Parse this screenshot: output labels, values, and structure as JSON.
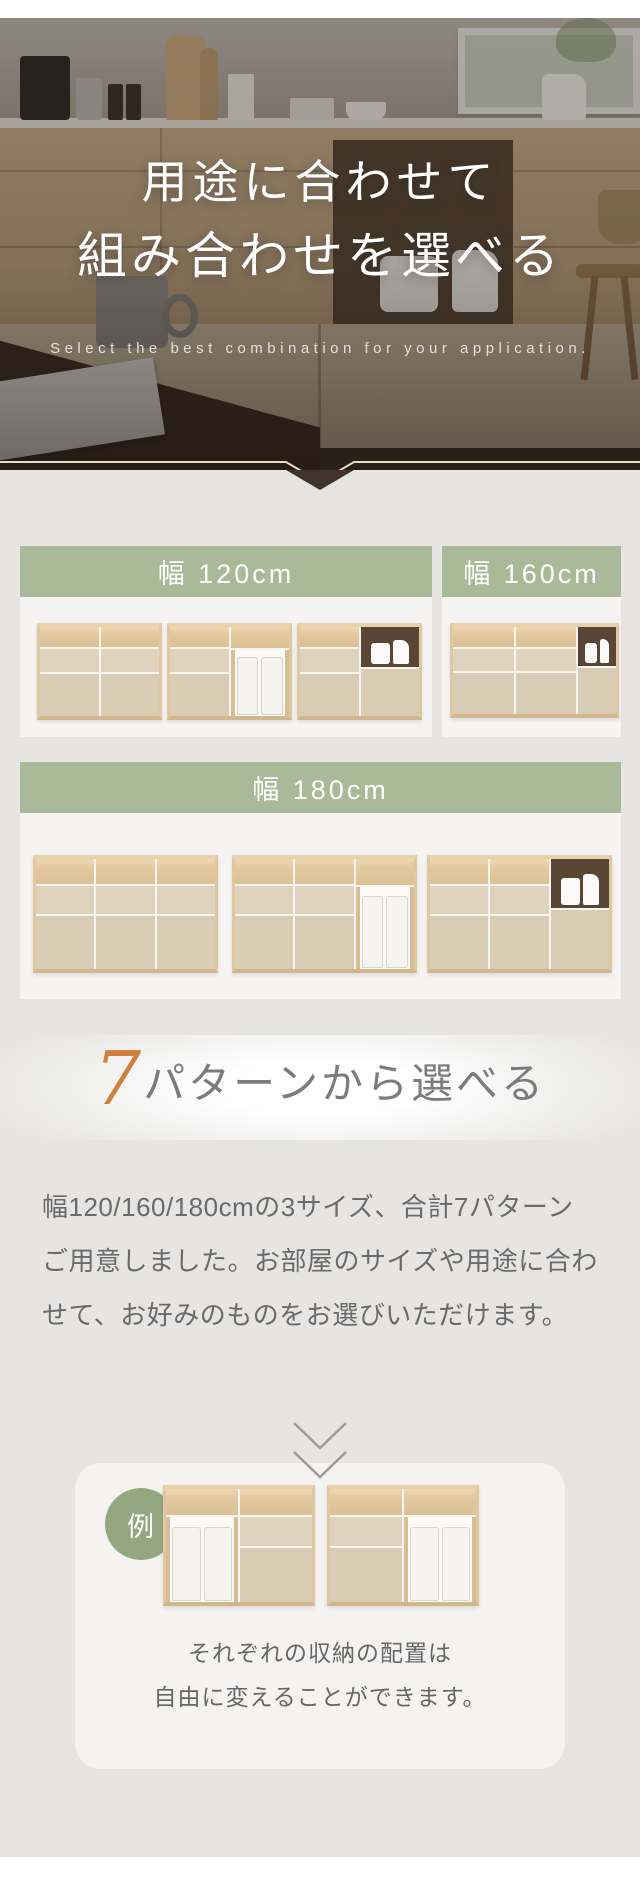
{
  "hero": {
    "title_line1": "用途に合わせて",
    "title_line2": "組み合わせを選べる",
    "tagline": "Select the best combination for your application."
  },
  "size_sections": {
    "s120": {
      "label": "幅 120cm",
      "variant_count": 3
    },
    "s160": {
      "label": "幅 160cm",
      "variant_count": 1
    },
    "s180": {
      "label": "幅 180cm",
      "variant_count": 3
    }
  },
  "patterns_heading": {
    "number": "7",
    "text": "パターンから選べる"
  },
  "patterns_paragraph": {
    "line1": "幅120/160/180cmの3サイズ、合計7パターン",
    "line2": "ご用意しました。お部屋のサイズや用途に合わ",
    "line3": "せて、お好みのものをお選びいただけます。"
  },
  "example": {
    "badge": "例",
    "caption_line1": "それぞれの収納の配置は",
    "caption_line2": "自由に変えることができます。"
  },
  "colors": {
    "accent_green": "#a9ba98",
    "badge_green": "#93a881",
    "accent_orange": "#d0803c",
    "panel_white": "#f5f4f2",
    "page_gray": "#e6e5e3",
    "hero_chevron_brown": "#41332a",
    "hero_trim_cream": "#e7dcc4"
  },
  "cabinet_specs": {
    "w120_a": {
      "cols": [
        [
          "wood",
          "beige",
          "door"
        ],
        [
          "wood",
          "beige",
          "door"
        ]
      ]
    },
    "w120_b": {
      "cols": [
        [
          "wood",
          "beige",
          "door"
        ],
        [
          "wood",
          "bins"
        ]
      ]
    },
    "w120_c": {
      "cols": [
        [
          "wood",
          "beige",
          "door"
        ],
        [
          "niche",
          "bigdoor"
        ]
      ]
    },
    "w160": {
      "cols": [
        [
          "wood",
          "beige",
          "door"
        ],
        [
          "wood",
          "beige",
          "door"
        ],
        [
          "niche",
          "bigdoor"
        ]
      ],
      "narrow": [
        2
      ]
    },
    "w180_a": {
      "cols": [
        [
          "wood",
          "beige",
          "door"
        ],
        [
          "wood",
          "beige",
          "door"
        ],
        [
          "wood",
          "beige",
          "door"
        ]
      ]
    },
    "w180_b": {
      "cols": [
        [
          "wood",
          "beige",
          "door"
        ],
        [
          "wood",
          "beige",
          "door"
        ],
        [
          "wood",
          "bins"
        ]
      ]
    },
    "w180_c": {
      "cols": [
        [
          "wood",
          "beige",
          "door"
        ],
        [
          "wood",
          "beige",
          "door"
        ],
        [
          "niche",
          "bigdoor"
        ]
      ]
    },
    "ex_a": {
      "cols": [
        [
          "wood",
          "bins"
        ],
        [
          "wood",
          "beige",
          "door"
        ]
      ]
    },
    "ex_b": {
      "cols": [
        [
          "wood",
          "beige",
          "door"
        ],
        [
          "wood",
          "bins"
        ]
      ]
    }
  }
}
